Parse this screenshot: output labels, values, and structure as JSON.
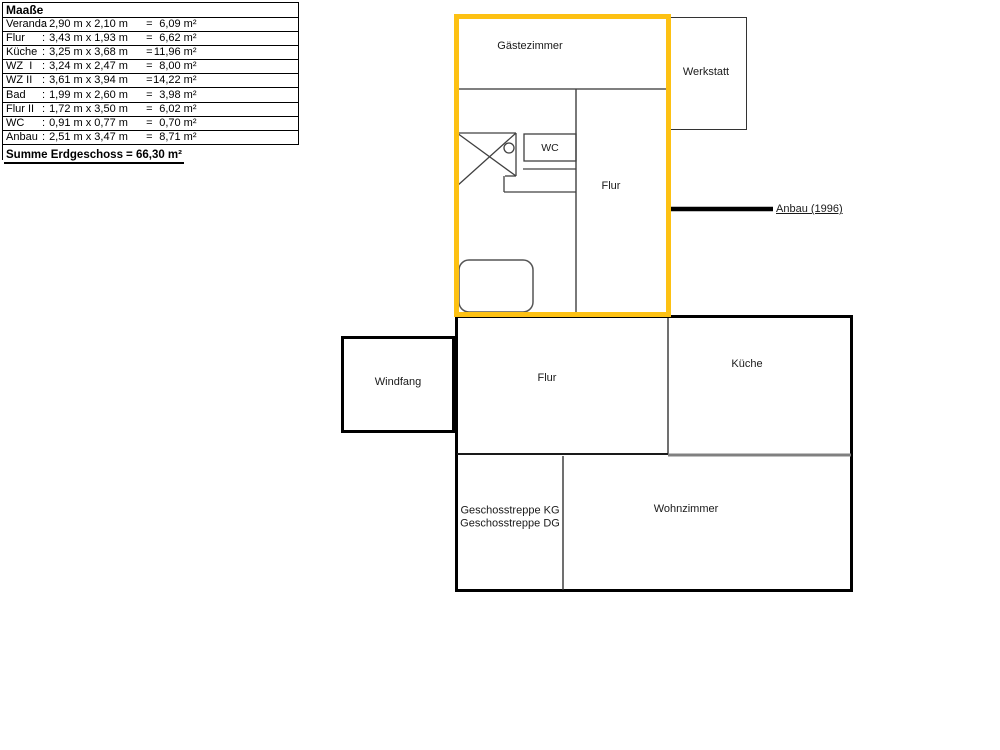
{
  "measurements": {
    "title": "Maaße",
    "colon": ":",
    "equals": "=",
    "rows": [
      {
        "name": "Veranda",
        "dims": "2,90 m x 2,10 m",
        "area": "6,09 m²"
      },
      {
        "name": "Flur",
        "dims": "3,43 m x 1,93 m",
        "area": "6,62 m²"
      },
      {
        "name": "Küche",
        "dims": "3,25 m x 3,68 m",
        "area": "11,96 m²"
      },
      {
        "name": "WZ  I",
        "dims": "3,24 m x 2,47 m",
        "area": "8,00 m²"
      },
      {
        "name": "WZ II",
        "dims": "3,61 m x 3,94 m",
        "area": "14,22 m²"
      },
      {
        "name": "Bad",
        "dims": "1,99 m x 2,60 m",
        "area": "3,98 m²"
      },
      {
        "name": "Flur II",
        "dims": "1,72 m x 3,50 m",
        "area": "6,02 m²"
      },
      {
        "name": "WC",
        "dims": "0,91 m x 0,77 m",
        "area": "0,70 m²"
      },
      {
        "name": "Anbau",
        "dims": "2,51 m x 3,47 m",
        "area": "8,71 m²"
      }
    ],
    "total_label": "Summe Erdgeschoss",
    "total_value": "= 66,30 m²"
  },
  "floorplan": {
    "rooms": {
      "gaestezimmer": "Gästezimmer",
      "werkstatt": "Werkstatt",
      "wc": "WC",
      "flur_upper": "Flur",
      "windfang": "Windfang",
      "flur_lower": "Flur",
      "kueche": "Küche",
      "geschosstreppe_kg": "Geschosstreppe KG",
      "geschosstreppe_dg": "Geschosstreppe DG",
      "wohnzimmer": "Wohnzimmer"
    },
    "annotation": "Anbau (1996)",
    "colors": {
      "highlight": "#FDC113",
      "wall": "#000000",
      "thin_wall": "#404040",
      "gray_wall": "#808080"
    }
  }
}
